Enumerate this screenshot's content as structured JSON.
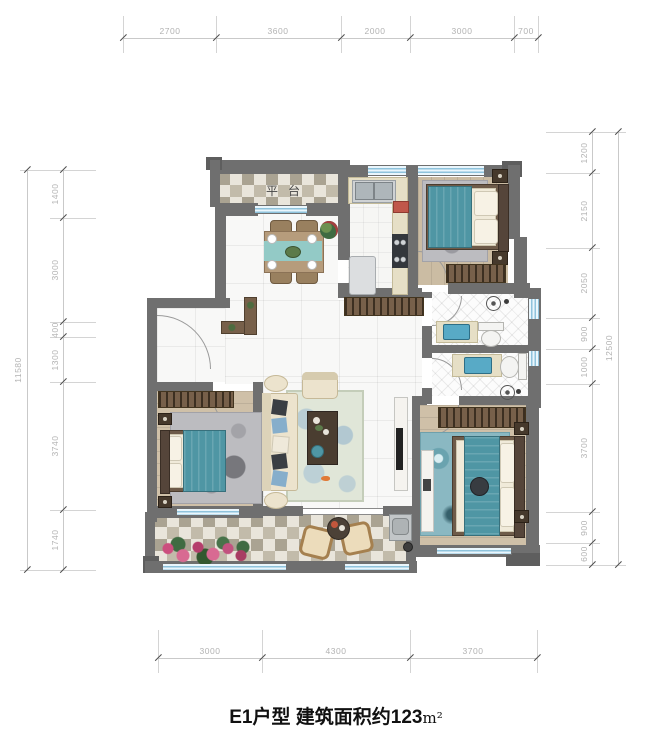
{
  "title": {
    "prefix": "E1户型 建筑面积约123",
    "unit": "m²"
  },
  "floor_plan": {
    "labels": {
      "platform": "平台"
    },
    "colors": {
      "wall": "#6f6f6f",
      "window_blue": "#8fc3dc",
      "bed_teal": "#4f96a4",
      "wood_floor": "#cfc0a8",
      "checker_tile_dark": "#aaa392",
      "dimension_text": "#b2b2b2",
      "title_text": "#111111"
    }
  },
  "dimensions": {
    "top": [
      "2700",
      "3600",
      "2000",
      "3000",
      "700"
    ],
    "bottom": [
      "3000",
      "4300",
      "3700"
    ],
    "left": [
      "1400",
      "3000",
      "400",
      "1300",
      "3740",
      "1740"
    ],
    "left_total": "11580",
    "right": [
      "1200",
      "2150",
      "2050",
      "900",
      "1000",
      "3700",
      "900",
      "600"
    ],
    "right_total": "12500"
  }
}
